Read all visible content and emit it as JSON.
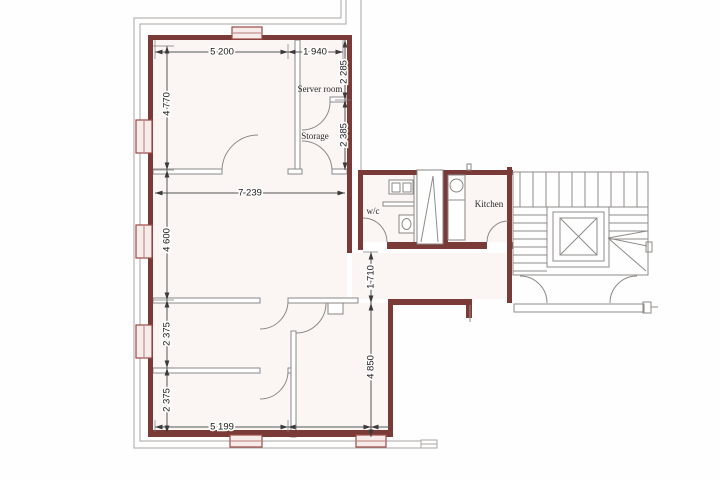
{
  "drawing": {
    "type": "architectural floor plan",
    "colors": {
      "wall": "#7a3b38",
      "outline_gray": "#aaa6a3",
      "interior_wall_gray": "#8a8a8a",
      "dimension": "#1c1c1c",
      "window_fill": "#f7ecea",
      "room_fill": "#fbf6f4"
    }
  },
  "rooms": {
    "server": "Server room",
    "storage": "Storage",
    "wc": "w/c",
    "kitchen": "Kitchen"
  },
  "dimensions": {
    "room_top_width": "5 200",
    "server_col_width": "1 940",
    "server_room_height": "2 285",
    "top_room_height": "4 770",
    "storage_height": "2 385",
    "middle_room_width": "7 239",
    "middle_room_height": "4 600",
    "hall_height": "1 710",
    "lower_room_a_height": "2 375",
    "lower_room_b_height": "2 375",
    "bottom_width": "5 199",
    "right_room_height": "4 850"
  }
}
